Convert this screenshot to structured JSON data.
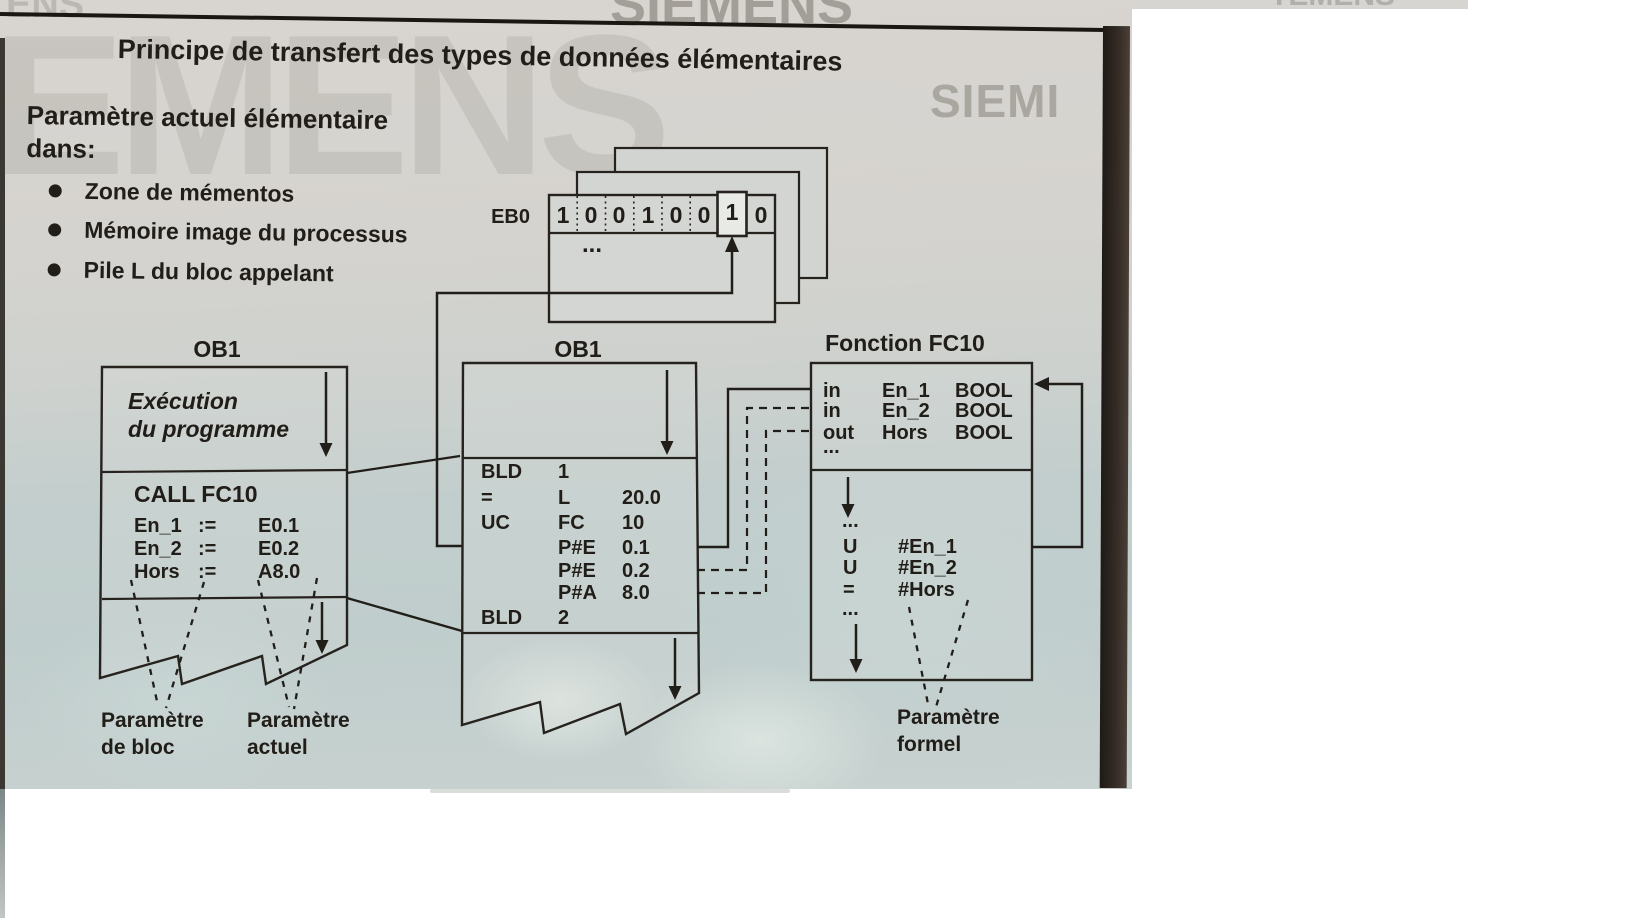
{
  "header": {
    "title": "Principe de transfert des types de données élémentaires",
    "intro_line1": "Paramètre actuel élémentaire",
    "intro_line2": "dans:",
    "bullets": [
      "Zone de mémentos",
      "Mémoire image du processus",
      "Pile L du bloc appelant"
    ]
  },
  "watermarks": {
    "giant": "EMENS",
    "top_cut": "SIEMENS",
    "right_partial": "SIEMI",
    "corner": "ENS",
    "sliver": "TEMENS"
  },
  "memory": {
    "label": "EB0",
    "bits": [
      "1",
      "0",
      "0",
      "1",
      "0",
      "0",
      "1",
      "0"
    ],
    "highlight_index": 6,
    "ellipsis": "..."
  },
  "ob1_left": {
    "title": "OB1",
    "exec_line1": "Exécution",
    "exec_line2": "du programme",
    "call": "CALL FC10",
    "params": [
      {
        "name": "En_1",
        "op": ":=",
        "value": "E0.1"
      },
      {
        "name": "En_2",
        "op": ":=",
        "value": "E0.2"
      },
      {
        "name": "Hors",
        "op": ":=",
        "value": "A8.0"
      }
    ],
    "label_block_1": "Paramètre",
    "label_block_2": "de bloc",
    "label_actual_1": "Paramètre",
    "label_actual_2": "actuel"
  },
  "ob1_middle": {
    "title": "OB1",
    "code": [
      {
        "c1": "BLD",
        "c2": "1",
        "c3": ""
      },
      {
        "c1": "=",
        "c2": "L",
        "c3": "20.0"
      },
      {
        "c1": "UC",
        "c2": "FC",
        "c3": "10"
      },
      {
        "c1": "",
        "c2": "P#E",
        "c3": "0.1"
      },
      {
        "c1": "",
        "c2": "P#E",
        "c3": "0.2"
      },
      {
        "c1": "",
        "c2": "P#A",
        "c3": "8.0"
      },
      {
        "c1": "BLD",
        "c2": "2",
        "c3": ""
      }
    ]
  },
  "fc10": {
    "title": "Fonction FC10",
    "interface": [
      {
        "dir": "in",
        "name": "En_1",
        "type": "BOOL"
      },
      {
        "dir": "in",
        "name": "En_2",
        "type": "BOOL"
      },
      {
        "dir": "out",
        "name": "Hors",
        "type": "BOOL"
      }
    ],
    "ellipsis": "...",
    "code": [
      {
        "op": "U",
        "operand": "#En_1"
      },
      {
        "op": "U",
        "operand": "#En_2"
      },
      {
        "op": "=",
        "operand": "#Hors"
      }
    ],
    "label_formal_1": "Paramètre",
    "label_formal_2": "formel"
  },
  "colors": {
    "ink": "#211d18",
    "page_top": "#d8d5d0",
    "page_bottom": "#c2cecd",
    "highlight_cell": "#e8eae6",
    "book_edge": "#2a241f"
  }
}
